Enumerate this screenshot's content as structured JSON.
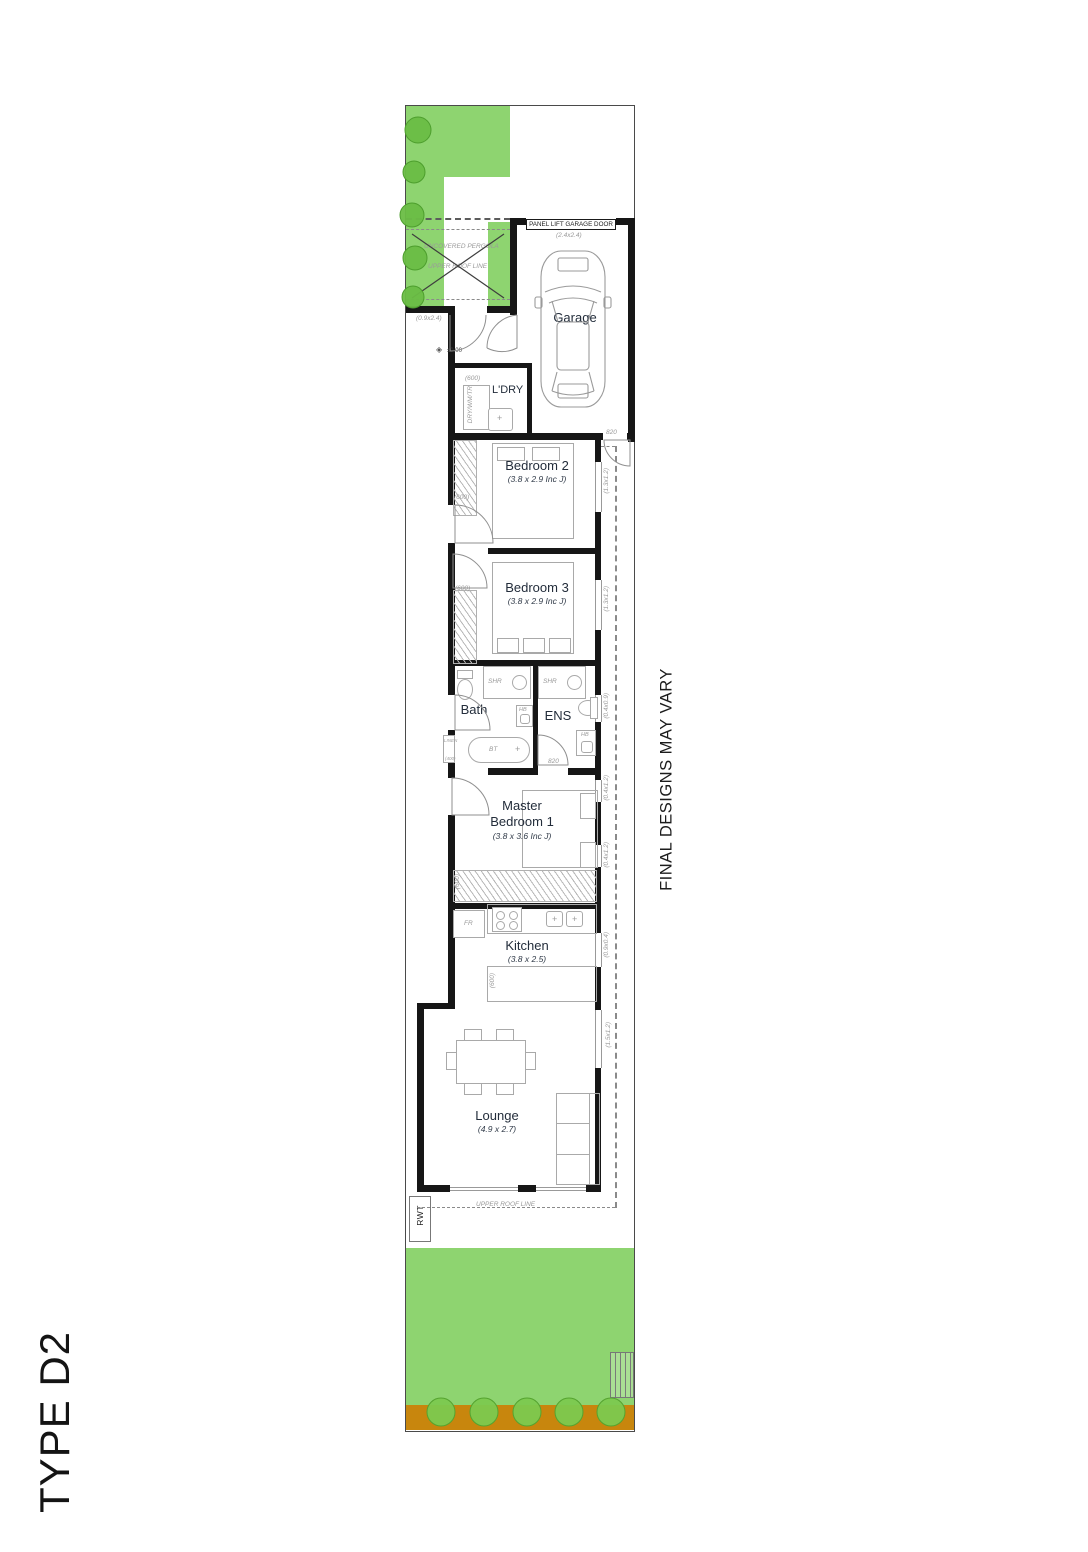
{
  "title": "TYPE D2",
  "disclaimer": "FINAL DESIGNS MAY VARY",
  "colors": {
    "grass": "#8ed470",
    "garden_bed": "#c8860d",
    "wall": "#161616"
  },
  "site": {
    "garage_door": "PANEL LIFT GARAGE DOOR",
    "garage_door_size": "(2.4x2.4)",
    "pergola": "UNCOVERED PERGOLA",
    "pergola_roof": "UPPER ROOF LINE",
    "entry_size": "(0.9x2.4)",
    "level": "±0.00",
    "rwt": "RWT",
    "roof_line": "UPPER ROOF LINE"
  },
  "rooms": {
    "garage": {
      "name": "Garage"
    },
    "laundry": {
      "name": "L'DRY",
      "appliances": "DRY/WM/TR",
      "bench": "(600)"
    },
    "bedroom2": {
      "name": "Bedroom 2",
      "size": "(3.8 x 2.9 Inc J)",
      "robe": "(600)"
    },
    "bedroom3": {
      "name": "Bedroom 3",
      "size": "(3.8 x 2.9 Inc J)",
      "robe": "(600)"
    },
    "bath": {
      "name": "Bath",
      "shower": "SHR",
      "basin": "HB",
      "bathtub": "BT",
      "linen": "LINEN",
      "linen_size": "(400)"
    },
    "ens": {
      "name": "ENS",
      "shower": "SHR",
      "basin": "HB",
      "door": "820"
    },
    "master": {
      "name_line1": "Master",
      "name_line2": "Bedroom 1",
      "size": "(3.8 x 3.6 Inc J)",
      "robe": "(600)"
    },
    "kitchen": {
      "name": "Kitchen",
      "size": "(3.8 x 2.5)",
      "fridge": "FR",
      "bench": "(600)"
    },
    "lounge": {
      "name": "Lounge",
      "size": "(4.9 x 2.7)"
    }
  },
  "doors": {
    "rear": "820"
  },
  "windows": [
    {
      "id": "bedroom2",
      "label": "(1.3x1.2)"
    },
    {
      "id": "bedroom3",
      "label": "(1.3x1.2)"
    },
    {
      "id": "ens",
      "label": "(0.4x0.9)"
    },
    {
      "id": "master-n",
      "label": "(0.4x1.2)"
    },
    {
      "id": "master-s",
      "label": "(0.4x1.2)"
    },
    {
      "id": "kitchen",
      "label": "(0.9x0.4)"
    },
    {
      "id": "lounge",
      "label": "(1.5x1.2)"
    }
  ]
}
